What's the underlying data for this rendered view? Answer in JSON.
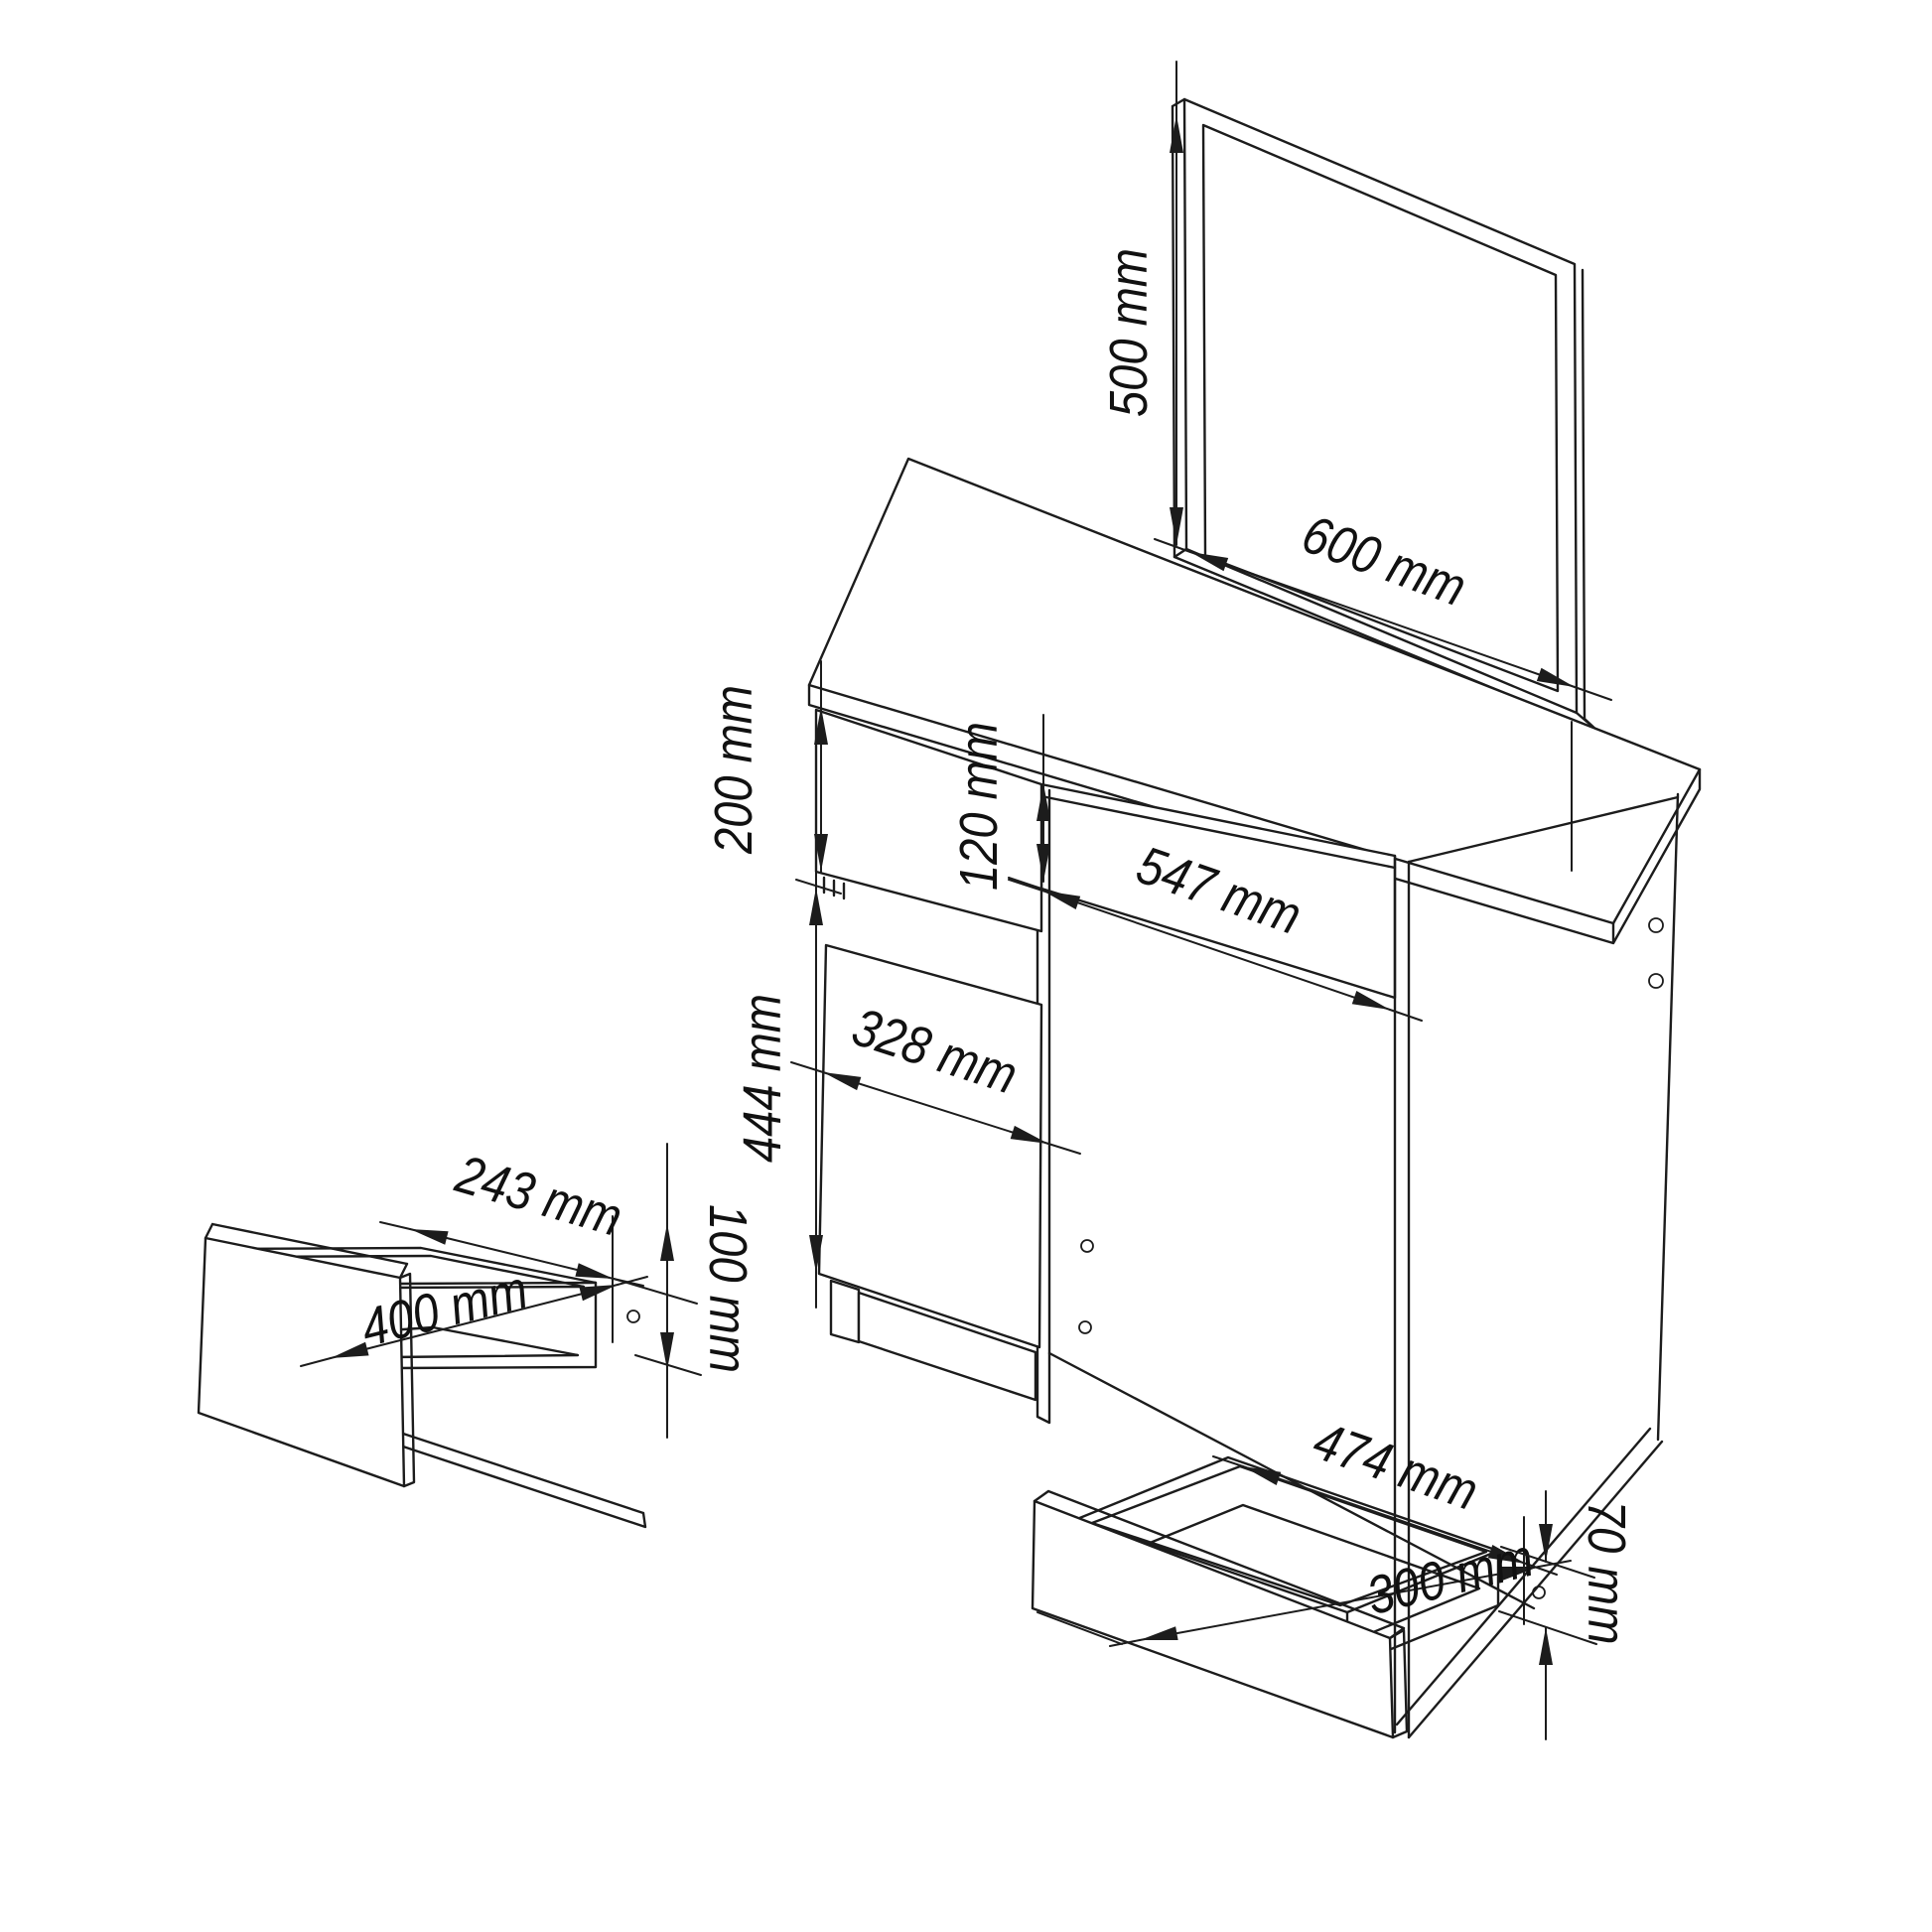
{
  "colors": {
    "line": "#1c1c1c",
    "background": "#ffffff"
  },
  "dimensions": {
    "mirror_height": "500 mm",
    "mirror_width": "600 mm",
    "top_drawer_height": "200 mm",
    "apron_height": "120 mm",
    "kneehole_width": "547 mm",
    "door_height": "444 mm",
    "door_width": "328 mm",
    "small_drawer_depth": "243 mm",
    "small_drawer_width": "400 mm",
    "small_drawer_height": "100 mm",
    "bottom_drawer_width": "474 mm",
    "bottom_drawer_depth": "300 mm",
    "bottom_drawer_height": "70 mm"
  }
}
